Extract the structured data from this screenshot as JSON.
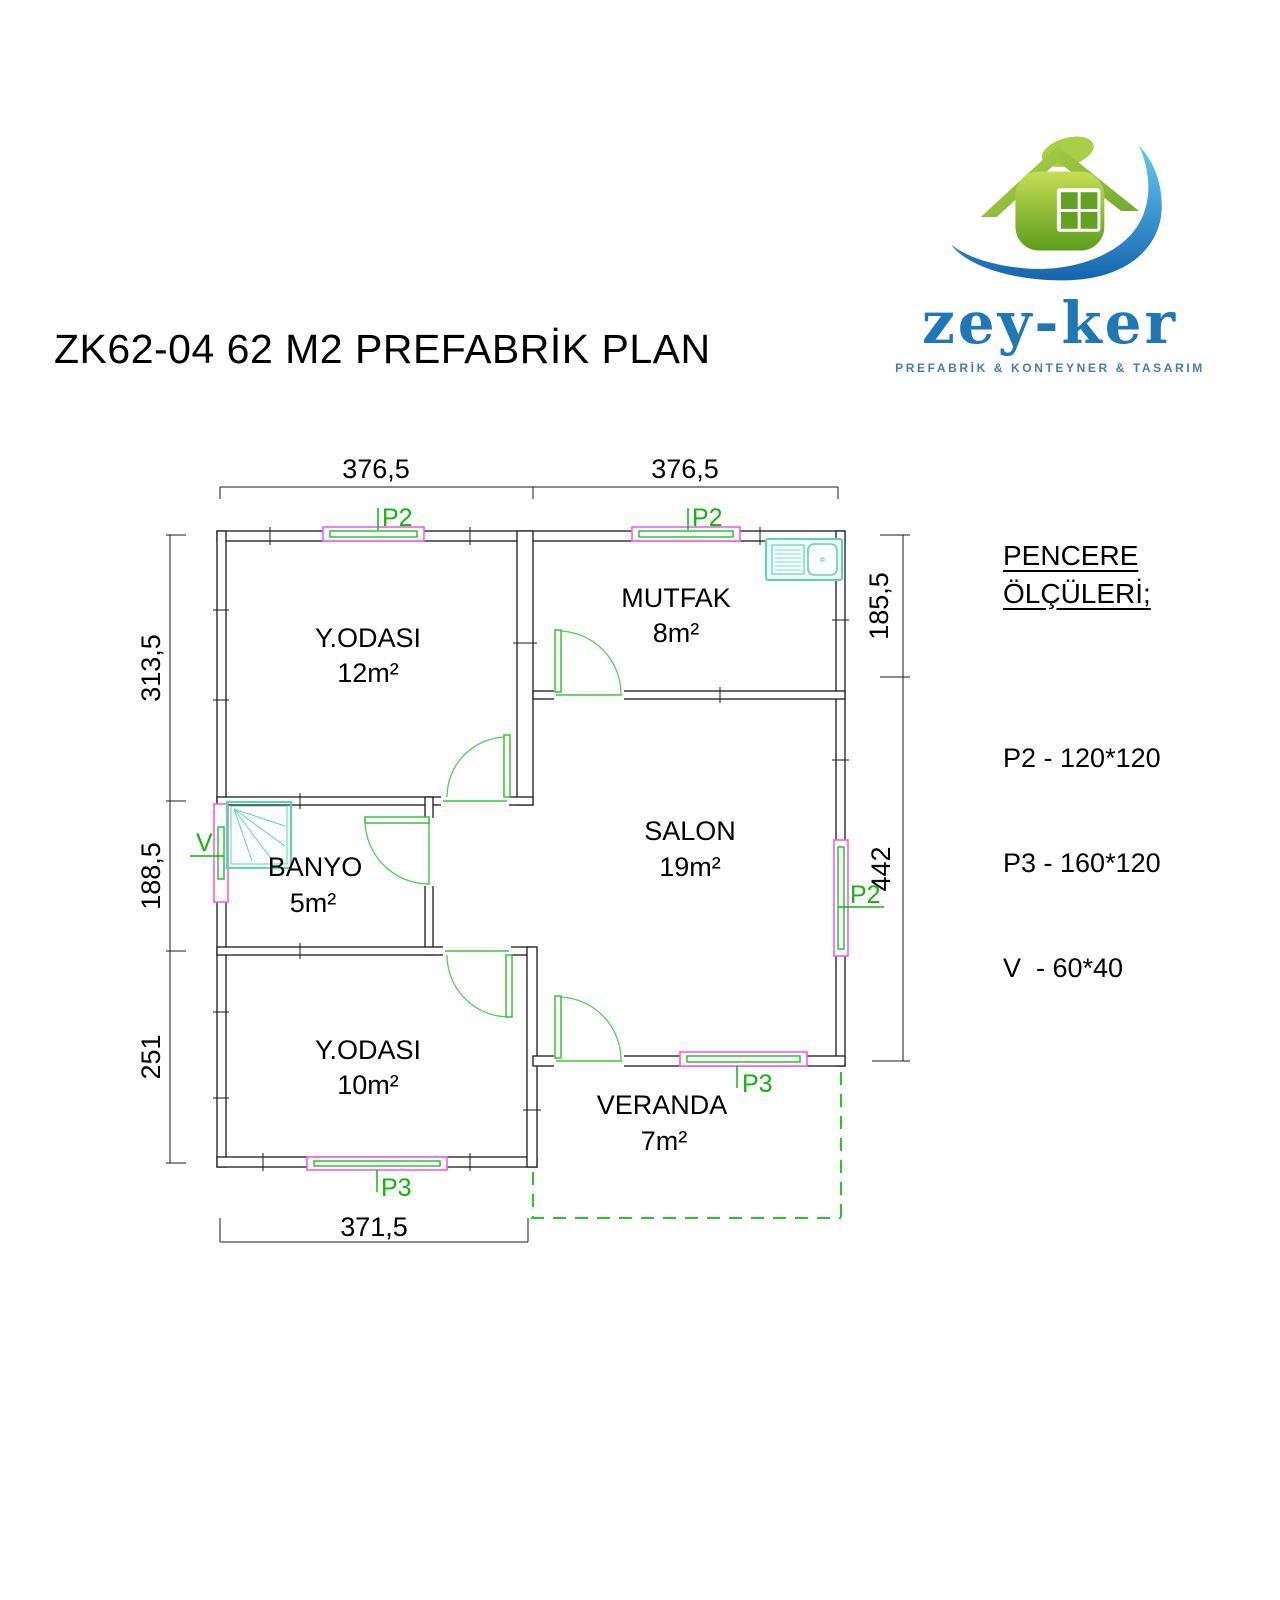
{
  "title": "ZK62-04 62 M2 PREFABRİK PLAN",
  "logo": {
    "brand": "zey-ker",
    "tagline": "PREFABRİK & KONTEYNER & TASARIM"
  },
  "legend": {
    "heading1": "PENCERE",
    "heading2": "ÖLÇÜLERİ;",
    "items": [
      "P2 - 120*120",
      "P3 - 160*120",
      "V  - 60*40"
    ]
  },
  "plan": {
    "rooms": [
      {
        "name": "Y.ODASI",
        "area": "12m²"
      },
      {
        "name": "MUTFAK",
        "area": "8m²"
      },
      {
        "name": "BANYO",
        "area": "5m²"
      },
      {
        "name": "SALON",
        "area": "19m²"
      },
      {
        "name": "Y.ODASI",
        "area": "10m²"
      },
      {
        "name": "VERANDA",
        "area": "7m²"
      }
    ],
    "dims": {
      "top": [
        "376,5",
        "376,5"
      ],
      "left": [
        "313,5",
        "188,5",
        "251"
      ],
      "right": [
        "185,5",
        "442"
      ],
      "bottom": [
        "371,5"
      ]
    },
    "tags": {
      "p2": "P2",
      "p3": "P3",
      "v": "V"
    },
    "colors": {
      "wall": "#1a1a1a",
      "annotation_green": "#12b412",
      "window_magenta": "#f25cf2",
      "fixture_teal": "#58d6b2",
      "logo_blue": "#2176b5",
      "logo_green": "#7ab33c"
    }
  }
}
